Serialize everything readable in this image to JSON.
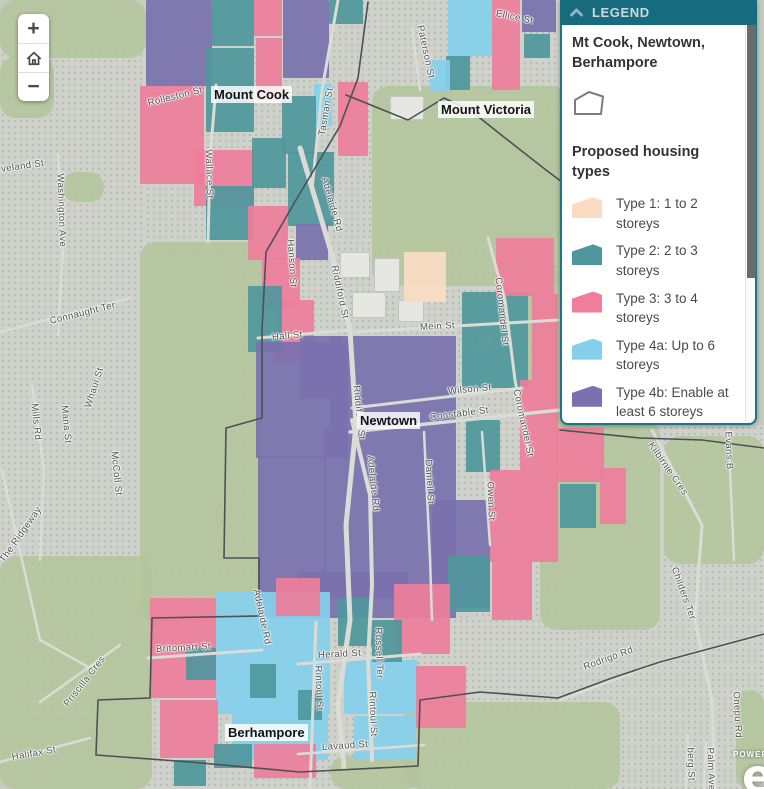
{
  "legend": {
    "header": "LEGEND",
    "collapse_icon": "chevron-up",
    "layer_title": "Mt Cook, Newtown, Berhampore",
    "layer_symbol": "polygon-outline",
    "section_title": "Proposed housing types",
    "header_bg": "#176b7e",
    "items": [
      {
        "label": "Type 1: 1 to 2 storeys",
        "color": "#fbdcc3"
      },
      {
        "label": "Type 2: 2 to 3 storeys",
        "color": "#4f979c"
      },
      {
        "label": "Type 3: 3 to 4 storeys",
        "color": "#ee7e9b"
      },
      {
        "label": "Type 4a: Up to 6 storeys",
        "color": "#85cfec"
      },
      {
        "label": "Type 4b: Enable at least 6 storeys",
        "color": "#7a71ae"
      }
    ]
  },
  "controls": {
    "zoom_in": "+",
    "zoom_out": "−",
    "home_icon": "home-icon"
  },
  "attribution": {
    "powered": "POWERED",
    "logo_letter": "e"
  },
  "map": {
    "place_labels": [
      {
        "text": "Mount Cook",
        "x": 211,
        "y": 86
      },
      {
        "text": "Mount Victoria",
        "x": 438,
        "y": 101
      },
      {
        "text": "Newtown",
        "x": 357,
        "y": 412
      },
      {
        "text": "Berhampore",
        "x": 225,
        "y": 724
      }
    ],
    "street_labels": [
      {
        "text": "Cleveland St",
        "x": -14,
        "y": 166,
        "r": -8
      },
      {
        "text": "Washington Ave",
        "x": 60,
        "y": 168,
        "r": 88
      },
      {
        "text": "Connaught Ter",
        "x": 50,
        "y": 316,
        "r": -14
      },
      {
        "text": "Whaui St",
        "x": 88,
        "y": 402,
        "r": -72
      },
      {
        "text": "Mills Rd",
        "x": 34,
        "y": 398,
        "r": 84
      },
      {
        "text": "Mana St",
        "x": 64,
        "y": 400,
        "r": 84
      },
      {
        "text": "McColl St",
        "x": 114,
        "y": 446,
        "r": 84
      },
      {
        "text": "The Ridgeway",
        "x": 2,
        "y": 556,
        "r": -55
      },
      {
        "text": "Priscilla Cres",
        "x": 66,
        "y": 700,
        "r": -52
      },
      {
        "text": "Halifax St",
        "x": 12,
        "y": 752,
        "r": -10
      },
      {
        "text": "Rolleston St",
        "x": 148,
        "y": 98,
        "r": -14
      },
      {
        "text": "Tasman St",
        "x": 322,
        "y": 130,
        "r": -80
      },
      {
        "text": "Wallace St",
        "x": 208,
        "y": 144,
        "r": 88
      },
      {
        "text": "Paterson St",
        "x": 420,
        "y": 20,
        "r": 78
      },
      {
        "text": "Ellice St",
        "x": 496,
        "y": 8,
        "r": 12
      },
      {
        "text": "Adelaide Rd",
        "x": 324,
        "y": 172,
        "r": 74
      },
      {
        "text": "Hanson St",
        "x": 290,
        "y": 234,
        "r": 86
      },
      {
        "text": "Riddiford St",
        "x": 334,
        "y": 260,
        "r": 78
      },
      {
        "text": "Hall St",
        "x": 272,
        "y": 332,
        "r": -5
      },
      {
        "text": "Mein St",
        "x": 420,
        "y": 322,
        "r": -3
      },
      {
        "text": "Riddiford St",
        "x": 356,
        "y": 380,
        "r": 84
      },
      {
        "text": "Adelaide Rd",
        "x": 370,
        "y": 450,
        "r": 84
      },
      {
        "text": "Wilson St",
        "x": 448,
        "y": 386,
        "r": -5
      },
      {
        "text": "Constable St",
        "x": 430,
        "y": 412,
        "r": -7
      },
      {
        "text": "Coromandel St",
        "x": 498,
        "y": 272,
        "r": 84
      },
      {
        "text": "Coromandel St",
        "x": 516,
        "y": 384,
        "r": 78
      },
      {
        "text": "Daniell St",
        "x": 428,
        "y": 454,
        "r": 87
      },
      {
        "text": "Owen St",
        "x": 490,
        "y": 476,
        "r": 88
      },
      {
        "text": "Adelaide Rd",
        "x": 256,
        "y": 584,
        "r": 78
      },
      {
        "text": "Britomart St",
        "x": 156,
        "y": 644,
        "r": -3
      },
      {
        "text": "Herald St",
        "x": 318,
        "y": 650,
        "r": -3
      },
      {
        "text": "Rintoul St",
        "x": 318,
        "y": 660,
        "r": 88
      },
      {
        "text": "Rintoul St",
        "x": 372,
        "y": 686,
        "r": 88
      },
      {
        "text": "Russell Ter",
        "x": 378,
        "y": 622,
        "r": 88
      },
      {
        "text": "Lavaud St",
        "x": 322,
        "y": 742,
        "r": -4
      },
      {
        "text": "Kilbirnie Cres",
        "x": 650,
        "y": 438,
        "r": 55
      },
      {
        "text": "Evans B",
        "x": 728,
        "y": 426,
        "r": 88
      },
      {
        "text": "Childers Ter",
        "x": 674,
        "y": 562,
        "r": 70
      },
      {
        "text": "Rodrigo Rd",
        "x": 584,
        "y": 662,
        "r": -20
      },
      {
        "text": "Onepu Rd",
        "x": 736,
        "y": 686,
        "r": 87
      },
      {
        "text": "Palm Ave",
        "x": 710,
        "y": 742,
        "r": 88
      },
      {
        "text": "berg St",
        "x": 690,
        "y": 742,
        "r": 88
      }
    ],
    "urban_areas": [
      [
        0,
        40,
        148,
        560
      ],
      [
        18,
        588,
        80,
        130
      ],
      [
        145,
        0,
        240,
        250
      ],
      [
        360,
        0,
        204,
        132
      ],
      [
        240,
        240,
        322,
        392
      ],
      [
        140,
        560,
        332,
        229
      ],
      [
        560,
        425,
        204,
        364
      ],
      [
        404,
        618,
        176,
        104
      ]
    ],
    "parks": [
      [
        0,
        0,
        146,
        58
      ],
      [
        0,
        56,
        54,
        62
      ],
      [
        62,
        172,
        42,
        30
      ],
      [
        372,
        86,
        196,
        200
      ],
      [
        528,
        270,
        122,
        160
      ],
      [
        540,
        420,
        120,
        210
      ],
      [
        140,
        242,
        122,
        380
      ],
      [
        0,
        556,
        152,
        233
      ],
      [
        404,
        702,
        216,
        87
      ],
      [
        330,
        756,
        92,
        33
      ],
      [
        664,
        436,
        100,
        128
      ],
      [
        736,
        690,
        28,
        99
      ]
    ],
    "buildings": [
      [
        340,
        252,
        30,
        26
      ],
      [
        374,
        258,
        26,
        34
      ],
      [
        352,
        292,
        34,
        26
      ],
      [
        398,
        300,
        26,
        22
      ],
      [
        390,
        96,
        34,
        24
      ]
    ],
    "parcels": [
      [
        5,
        146,
        0,
        66,
        86
      ],
      [
        2,
        212,
        0,
        42,
        46
      ],
      [
        3,
        254,
        0,
        28,
        36
      ],
      [
        5,
        283,
        0,
        46,
        78
      ],
      [
        2,
        329,
        0,
        34,
        24
      ],
      [
        3,
        140,
        86,
        64,
        98
      ],
      [
        2,
        206,
        48,
        48,
        84
      ],
      [
        3,
        256,
        38,
        26,
        62
      ],
      [
        4,
        314,
        84,
        18,
        42
      ],
      [
        2,
        282,
        96,
        34,
        58
      ],
      [
        3,
        338,
        82,
        30,
        74
      ],
      [
        2,
        288,
        152,
        46,
        74
      ],
      [
        3,
        194,
        150,
        60,
        56
      ],
      [
        2,
        206,
        186,
        48,
        54
      ],
      [
        3,
        248,
        206,
        40,
        54
      ],
      [
        2,
        252,
        138,
        34,
        50
      ],
      [
        5,
        296,
        224,
        32,
        36
      ],
      [
        3,
        262,
        258,
        38,
        50
      ],
      [
        4,
        448,
        0,
        44,
        56
      ],
      [
        3,
        492,
        0,
        28,
        90
      ],
      [
        2,
        446,
        56,
        24,
        34
      ],
      [
        5,
        522,
        0,
        34,
        32
      ],
      [
        2,
        524,
        34,
        26,
        24
      ],
      [
        4,
        430,
        60,
        20,
        32
      ],
      [
        1,
        404,
        252,
        42,
        50
      ],
      [
        1,
        479,
        336,
        12,
        13
      ],
      [
        3,
        276,
        300,
        38,
        62
      ],
      [
        5,
        300,
        336,
        42,
        62
      ],
      [
        2,
        248,
        286,
        34,
        66
      ],
      [
        2,
        462,
        292,
        66,
        96
      ],
      [
        3,
        496,
        238,
        58,
        58
      ],
      [
        3,
        532,
        294,
        26,
        86
      ],
      [
        3,
        520,
        380,
        38,
        90
      ],
      [
        5,
        256,
        342,
        92,
        116
      ],
      [
        5,
        258,
        456,
        68,
        162
      ],
      [
        5,
        330,
        336,
        126,
        92
      ],
      [
        5,
        324,
        428,
        132,
        190
      ],
      [
        5,
        432,
        500,
        58,
        108
      ],
      [
        2,
        466,
        420,
        34,
        52
      ],
      [
        3,
        490,
        470,
        68,
        92
      ],
      [
        2,
        448,
        556,
        42,
        56
      ],
      [
        3,
        492,
        560,
        40,
        60
      ],
      [
        3,
        556,
        428,
        48,
        54
      ],
      [
        2,
        560,
        484,
        36,
        44
      ],
      [
        3,
        600,
        468,
        26,
        56
      ],
      [
        5,
        298,
        572,
        110,
        26
      ],
      [
        4,
        216,
        592,
        114,
        122
      ],
      [
        4,
        232,
        702,
        96,
        58
      ],
      [
        4,
        344,
        660,
        74,
        54
      ],
      [
        4,
        354,
        716,
        62,
        44
      ],
      [
        3,
        150,
        598,
        66,
        100
      ],
      [
        3,
        160,
        700,
        58,
        58
      ],
      [
        2,
        186,
        648,
        30,
        32
      ],
      [
        3,
        276,
        578,
        44,
        38
      ],
      [
        2,
        338,
        598,
        34,
        48
      ],
      [
        3,
        394,
        584,
        56,
        70
      ],
      [
        2,
        372,
        620,
        30,
        42
      ],
      [
        3,
        416,
        666,
        50,
        62
      ],
      [
        2,
        250,
        664,
        26,
        34
      ],
      [
        2,
        298,
        690,
        24,
        30
      ],
      [
        2,
        214,
        744,
        38,
        24
      ],
      [
        3,
        254,
        744,
        62,
        34
      ],
      [
        2,
        174,
        760,
        32,
        26
      ]
    ],
    "roads": [
      {
        "pts": "300,148 332,255 350,330 356,425 346,525 350,620 338,705 344,768",
        "w": 5
      },
      {
        "pts": "352,420 370,495 372,585 368,660 372,760",
        "w": 4
      },
      {
        "pts": "338,0 322,90 312,190 302,150",
        "w": 3
      },
      {
        "pts": "216,85 210,160 208,242",
        "w": 3
      },
      {
        "pts": "258,338 352,330",
        "w": 3
      },
      {
        "pts": "356,332 558,320",
        "w": 3
      },
      {
        "pts": "352,408 522,388",
        "w": 3
      },
      {
        "pts": "350,432 560,410",
        "w": 3.5
      },
      {
        "pts": "488,238 505,300 515,380 528,450",
        "w": 3
      },
      {
        "pts": "424,432 430,558 432,620",
        "w": 2.5
      },
      {
        "pts": "482,432 490,545",
        "w": 2.5
      },
      {
        "pts": "148,658 262,650",
        "w": 3
      },
      {
        "pts": "298,664 420,654",
        "w": 3
      },
      {
        "pts": "316,622 310,789",
        "w": 3
      },
      {
        "pts": "298,754 424,745",
        "w": 2.5
      },
      {
        "pts": "58,155 63,250 58,335",
        "w": 2.5
      },
      {
        "pts": "0,332 130,298",
        "w": 2.5
      },
      {
        "pts": "32,385 44,470 40,560",
        "w": 2.5
      },
      {
        "pts": "2,470 22,560 40,640 90,668",
        "w": 2.5
      },
      {
        "pts": "40,702 120,645",
        "w": 2.5
      },
      {
        "pts": "0,762 90,738",
        "w": 2.5
      },
      {
        "pts": "652,430 702,525 695,620 712,700 715,789",
        "w": 3
      },
      {
        "pts": "728,425 734,560",
        "w": 2.5
      },
      {
        "pts": "560,700 660,662 764,634",
        "w": 3
      },
      {
        "pts": "688,735 686,789",
        "w": 2.5
      },
      {
        "pts": "706,742 704,789",
        "w": 2.5
      },
      {
        "pts": "412,28 420,90",
        "w": 2.5
      }
    ],
    "boundaries": [
      "368,2 358,78 340,126 296,200 266,252 262,330 262,418 226,428 224,558 259,558 259,616 152,618 150,698 98,700 96,755 190,762 300,772 418,766 420,700 480,692 558,698",
      "346,95 408,120 444,98 470,110 500,134 546,170 562,182",
      "560,430 640,438 702,440 764,448",
      "558,698 612,678 660,662 764,634"
    ]
  }
}
